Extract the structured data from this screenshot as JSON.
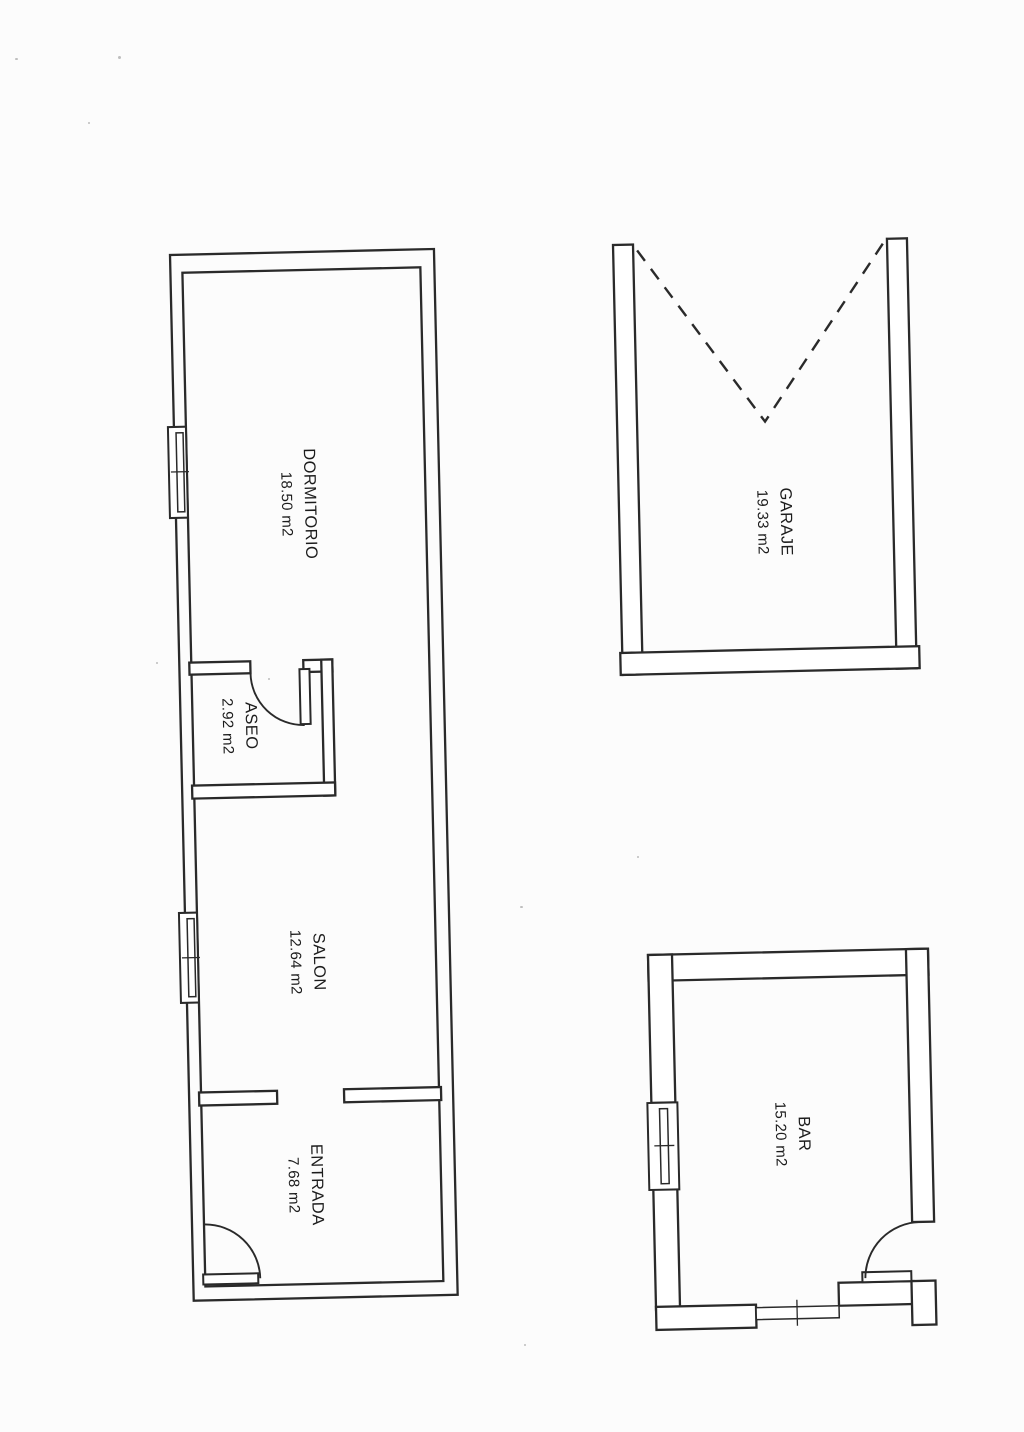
{
  "rooms": [
    {
      "id": "dormitorio",
      "name": "DORMITORIO",
      "area": "18.50 m2"
    },
    {
      "id": "aseo",
      "name": "ASEO",
      "area": "2.92 m2"
    },
    {
      "id": "salon",
      "name": "SALON",
      "area": "12.64 m2"
    },
    {
      "id": "entrada",
      "name": "ENTRADA",
      "area": "7.68 m2"
    },
    {
      "id": "garaje",
      "name": "GARAJE",
      "area": "19.33 m2"
    },
    {
      "id": "bar",
      "name": "BAR",
      "area": "15.20 m2"
    }
  ],
  "colors": {
    "line": "#2a2a2a",
    "paper": "#fcfcfc",
    "text": "#1c1c1c"
  }
}
